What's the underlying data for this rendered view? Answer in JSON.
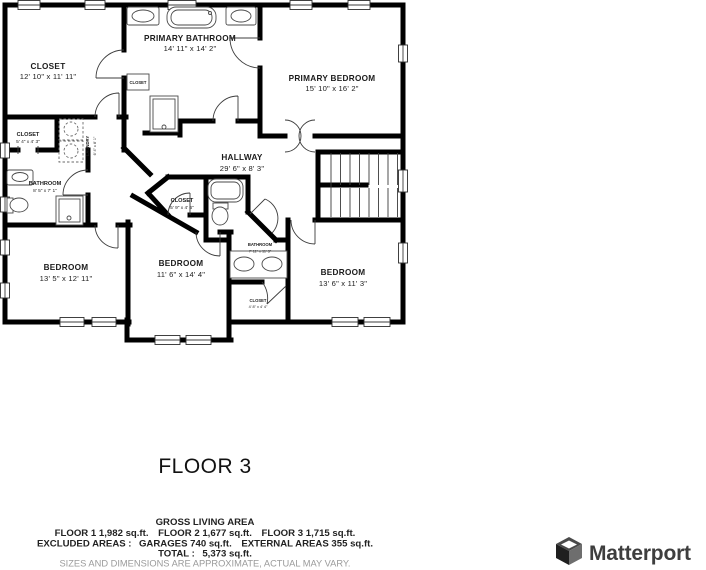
{
  "floor_plan": {
    "floor_label": "FLOOR 3",
    "rooms": {
      "closet_tl": {
        "name": "CLOSET",
        "dims": "12' 10\" x 11' 11\""
      },
      "primary_bathroom": {
        "name": "PRIMARY BATHROOM",
        "dims": "14' 11\" x 14' 2\""
      },
      "primary_bedroom": {
        "name": "PRIMARY BEDROOM",
        "dims": "15' 10\" x 16' 2\""
      },
      "hallway": {
        "name": "HALLWAY",
        "dims": "29' 6\" x 8' 3\""
      },
      "closet_left": {
        "name": "CLOSET",
        "dims": "5' 4\" x 4' 3\""
      },
      "laundry": {
        "name": "LAUNDRY",
        "dims": "6' 4\" x 8' 1\""
      },
      "bathroom_left": {
        "name": "BATHROOM",
        "dims": "8' 5\" x 7' 1\""
      },
      "closet_hall": {
        "name": "CLOSET",
        "dims": "5' 9\" x 4' 6\""
      },
      "bathroom_middle": {
        "name": "BATHROOM",
        "dims": "7' 11\" x 11' 3\""
      },
      "closet_bottom": {
        "name": "CLOSET",
        "dims": "4' 8\" x 4' 4\""
      },
      "closet_bath_nook": {
        "name": "CLOSET"
      },
      "bedroom_left": {
        "name": "BEDROOM",
        "dims": "13' 5\" x 12' 11\""
      },
      "bedroom_middle": {
        "name": "BEDROOM",
        "dims": "11' 6\" x 14' 4\""
      },
      "bedroom_right": {
        "name": "BEDROOM",
        "dims": "13' 6\" x 11' 3\""
      }
    }
  },
  "summary": {
    "title": "GROSS LIVING AREA",
    "line_floors": "FLOOR 1 1,982 sq.ft.  FLOOR 2 1,677 sq.ft.  FLOOR 3 1,715 sq.ft.",
    "line_excluded": "EXCLUDED AREAS :  GARAGES 740 sq.ft.  EXTERNAL AREAS 355 sq.ft.",
    "line_total": "TOTAL :  5,373 sq.ft.",
    "disclaimer": "SIZES AND DIMENSIONS ARE APPROXIMATE, ACTUAL MAY VARY."
  },
  "branding": {
    "logo_text": "Matterport"
  },
  "colors": {
    "wall": "#000000",
    "background": "#ffffff",
    "disclaimer_text": "#9a9a9a",
    "logo_text": "#3e3e3e"
  }
}
